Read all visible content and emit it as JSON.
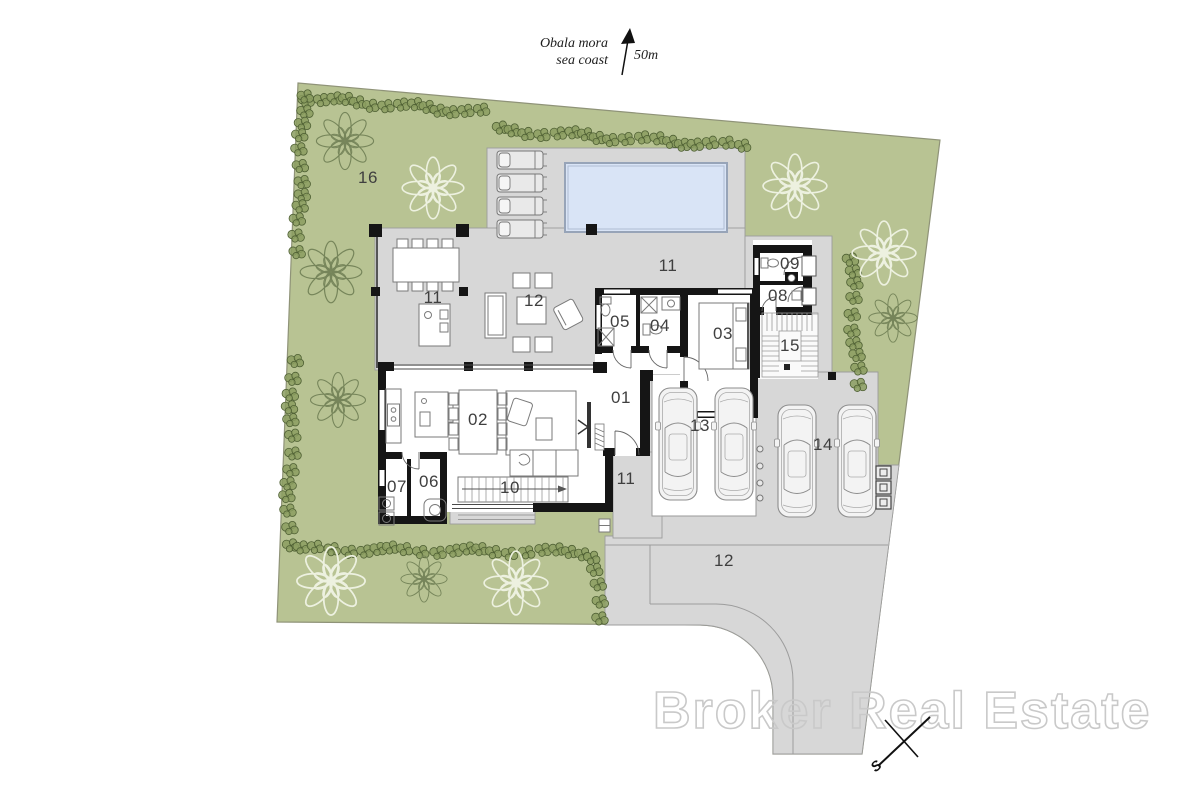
{
  "annotation": {
    "line1": "Obala mora",
    "line2": "sea coast",
    "distance_label": "50m"
  },
  "watermark_text": "Broker Real Estate",
  "compass_label": "S",
  "colors": {
    "grass": "#b8c393",
    "grass_stroke": "#8f9378",
    "paved": "#d7d7d7",
    "paved_stroke": "#9c9c9c",
    "wall": "#151515",
    "water": "#d9e4f6",
    "water_stroke": "#97a4b8",
    "hedge_fill": "#8b9d60",
    "hedge_stroke": "#4f6034",
    "tree_dark": "#76855a",
    "tree_light": "#edf1e0",
    "furn": "#7a7a7a",
    "label": "#3f3f3f",
    "watermark": "#c9c9c9"
  },
  "area_labels": [
    {
      "text": "16",
      "x": 368,
      "y": 183
    },
    {
      "text": "11",
      "x": 433,
      "y": 303
    },
    {
      "text": "12",
      "x": 534,
      "y": 306
    },
    {
      "text": "11",
      "x": 668,
      "y": 271
    },
    {
      "text": "05",
      "x": 620,
      "y": 327
    },
    {
      "text": "04",
      "x": 660,
      "y": 331
    },
    {
      "text": "03",
      "x": 723,
      "y": 339
    },
    {
      "text": "09",
      "x": 790,
      "y": 269
    },
    {
      "text": "08",
      "x": 778,
      "y": 301
    },
    {
      "text": "15",
      "x": 790,
      "y": 351
    },
    {
      "text": "01",
      "x": 621,
      "y": 403
    },
    {
      "text": "02",
      "x": 478,
      "y": 425
    },
    {
      "text": "06",
      "x": 429,
      "y": 487
    },
    {
      "text": "07",
      "x": 397,
      "y": 492
    },
    {
      "text": "10",
      "x": 510,
      "y": 493
    },
    {
      "text": "13",
      "x": 700,
      "y": 431
    },
    {
      "text": "14",
      "x": 823,
      "y": 450
    },
    {
      "text": "11",
      "x": 626,
      "y": 484
    },
    {
      "text": "12",
      "x": 724,
      "y": 566
    }
  ],
  "trees": [
    {
      "x": 345,
      "y": 141,
      "r": 26,
      "style": "dark"
    },
    {
      "x": 331,
      "y": 272,
      "r": 28,
      "style": "dark"
    },
    {
      "x": 338,
      "y": 400,
      "r": 25,
      "style": "dark"
    },
    {
      "x": 424,
      "y": 579,
      "r": 21,
      "style": "dark"
    },
    {
      "x": 893,
      "y": 318,
      "r": 22,
      "style": "dark"
    },
    {
      "x": 433,
      "y": 188,
      "r": 28,
      "style": "light"
    },
    {
      "x": 795,
      "y": 186,
      "r": 29,
      "style": "light"
    },
    {
      "x": 884,
      "y": 253,
      "r": 29,
      "style": "light"
    },
    {
      "x": 331,
      "y": 581,
      "r": 31,
      "style": "light"
    },
    {
      "x": 516,
      "y": 583,
      "r": 29,
      "style": "light"
    }
  ],
  "hedge_segments": [
    {
      "x1": 306,
      "y1": 98,
      "x2": 480,
      "y2": 112,
      "count": 14
    },
    {
      "x1": 303,
      "y1": 95,
      "x2": 298,
      "y2": 250,
      "count": 12
    },
    {
      "x1": 293,
      "y1": 362,
      "x2": 288,
      "y2": 543,
      "count": 13
    },
    {
      "x1": 500,
      "y1": 130,
      "x2": 740,
      "y2": 146,
      "count": 18
    },
    {
      "x1": 303,
      "y1": 549,
      "x2": 585,
      "y2": 552,
      "count": 20
    },
    {
      "x1": 594,
      "y1": 557,
      "x2": 599,
      "y2": 616,
      "count": 5
    },
    {
      "x1": 851,
      "y1": 257,
      "x2": 857,
      "y2": 385,
      "count": 10
    }
  ],
  "pool": {
    "x": 565,
    "y": 163,
    "w": 162,
    "h": 69
  },
  "loungers": [
    {
      "x": 497,
      "y": 151
    },
    {
      "x": 497,
      "y": 174
    },
    {
      "x": 497,
      "y": 197
    },
    {
      "x": 497,
      "y": 220
    }
  ],
  "cars": [
    {
      "x": 658,
      "y": 386
    },
    {
      "x": 714,
      "y": 386
    },
    {
      "x": 777,
      "y": 403
    },
    {
      "x": 837,
      "y": 403
    }
  ],
  "bollards": {
    "x": 760,
    "ys": [
      449,
      466,
      483,
      498
    ],
    "r": 3
  },
  "bins": [
    {
      "x": 876,
      "y": 466
    },
    {
      "x": 876,
      "y": 481
    },
    {
      "x": 876,
      "y": 496
    }
  ]
}
